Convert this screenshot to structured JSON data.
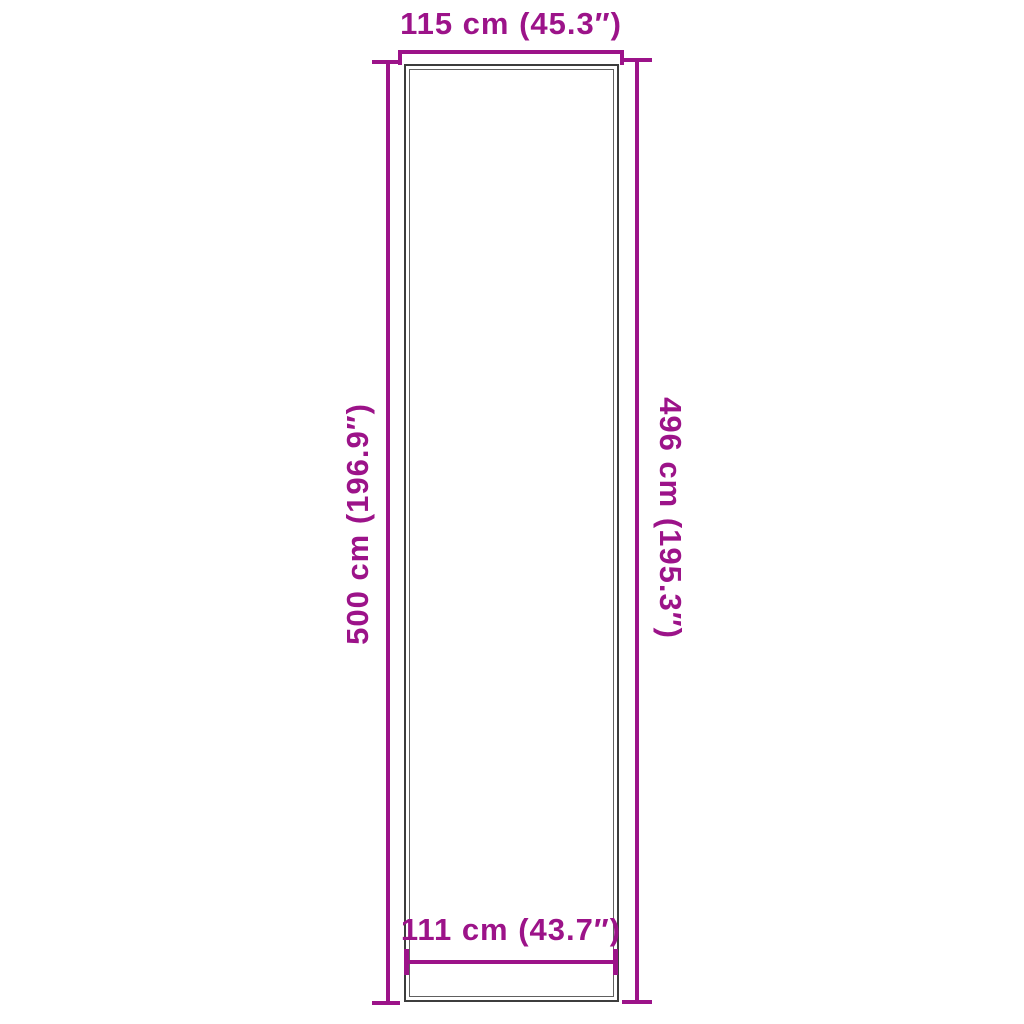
{
  "diagram": {
    "description": "Product dimension diagram of a tall rectangular rug runner viewed from above",
    "colors": {
      "accent": "#9c1389",
      "outline_dark": "#3d3d3d",
      "outline_light": "#606060",
      "background": "#ffffff"
    },
    "dimensions": {
      "top": {
        "label": "115 cm (45.3″)"
      },
      "left": {
        "label": "500 cm (196.9″)"
      },
      "right": {
        "label": "496 cm (195.3″)"
      },
      "bottom": {
        "label": "111 cm (43.7″)"
      }
    }
  }
}
